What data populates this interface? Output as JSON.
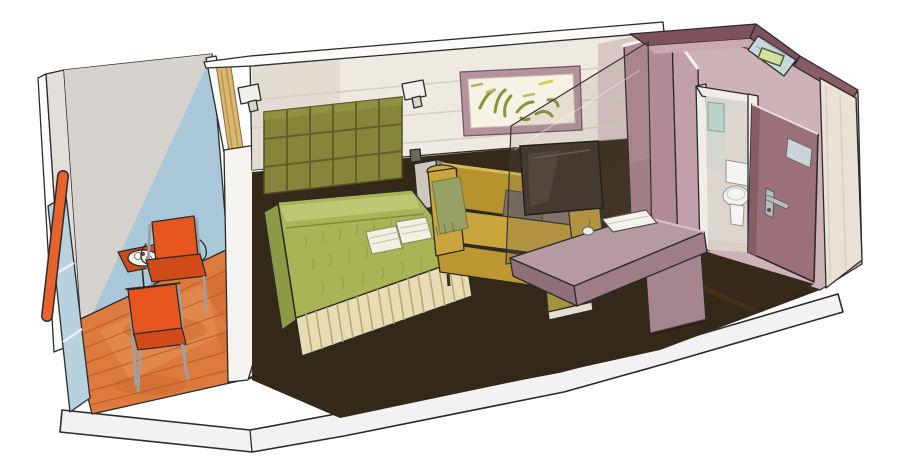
{
  "title": "Cruise ship balcony cabin — hand-drawn cutaway illustration",
  "scene": {
    "balcony": [
      "side-wall",
      "glass-back-wall",
      "wood-deck",
      "railing-with-orange-handrail",
      "two-orange-chairs",
      "bistro-table",
      "tray-with-cups"
    ],
    "bedroom": [
      "tufted-headboard",
      "double-bed-green-spread",
      "pleated-bed-skirt",
      "two-folded-towels",
      "curtain",
      "two-wall-sconces",
      "outlet",
      "nightstand"
    ],
    "living_area": [
      "mustard-sofa",
      "olive-throw",
      "two-back-cushions",
      "framed-abstract-artwork",
      "glass-partition",
      "flat-tv",
      "writing-desk",
      "stool",
      "notebook",
      "small-object"
    ],
    "bathroom": [
      "mauve-walls",
      "doorway",
      "mirror",
      "toilet",
      "ceiling-glass-panel",
      "light-fixture"
    ],
    "entry": [
      "open-cabin-door",
      "door-placard",
      "door-handle",
      "corridor-wall"
    ]
  },
  "palette": {
    "ink": "#2b2b2b",
    "paper": "#ffffff",
    "slab": "#f4f1f4",
    "balconySideWall": "#e2dfda",
    "balconyWallBlue": "#a9c7d9",
    "balconyWallGray": "#d6d3ce",
    "deck": "#dd7a3e",
    "deckWash": "#e89a62",
    "deckLine": "#b35a28",
    "deckShadow": "#c05820",
    "threshold": "#eceeec",
    "thresholdTick": "#555555",
    "railGlass": "#b7d1dd",
    "handrail": "#e8622e",
    "orangeFurniture": "#e8561f",
    "orangeDark": "#d14a1a",
    "metal": "#9aa2a8",
    "tray": "#f3f1ea",
    "partition": "#f6f4f0",
    "partitionTop": "#fbfaf8",
    "curtain": "#d9b873",
    "curtainFold": "#b9954a",
    "wall": "#eee9e1",
    "wallShade": "#ded8cf",
    "wallMauveTint": "#c9abb1",
    "wallPanelLine": "#d5cec3",
    "ceilingBand": "#fcfbf9",
    "headboard": "#85853c",
    "headboardHighlight": "#9a9a4a",
    "headboardLine": "#5d5d26",
    "sconce": "#f1efe9",
    "sconceBracket": "#d8d4cc",
    "outlet": "#6b665e",
    "nightstandFront": "#ccc8c0",
    "nightstandSide": "#8b857c",
    "carpet": "#342818",
    "carpetLight": "#443119",
    "bedTop": "#aab457",
    "bedFold": "#c3cc7a",
    "bedSide": "#8d9a45",
    "bedTexture": "#8a9840",
    "bedOverhang": "#9cab4e",
    "skirt": "#e7dcb4",
    "skirtStripe": "#b7a86f",
    "towel": "#f2efe3",
    "towelStripe": "#c9c2a4",
    "sofa": "#c9a53b",
    "sofaBack": "#b6932f",
    "sofaBase": "#bd9832",
    "sofaArmTop": "#cfab41",
    "sofaHighlight": "#d9b955",
    "cushionA": "#7a6c60",
    "cushionB": "#8a7b6d",
    "throw": "#97a065",
    "throwLine": "#6e7842",
    "artFrame": "#b4939c",
    "artCanvas": "#f6f2e4",
    "artStroke": "#8a9338",
    "artStrokeLight": "#b7bd62",
    "artStrokeTan": "#c9a86a",
    "artStrokeYellow": "#d8c84a",
    "glass": "rgba(125,112,98,0.14)",
    "glassLower": "rgba(95,82,70,0.12)",
    "tv": "#453a31",
    "tvReflection": "#564a3e",
    "desk": "#b59aa2",
    "deskFront": "#9d7e87",
    "deskSide": "#8f7079",
    "pedestal": "#a5858e",
    "stool": "#b7a34b",
    "stoolFront": "#a6923e",
    "stoolBase": "#e4dfd2",
    "notebook": "#f4f2ec",
    "vestibule": "#cdb2b8",
    "bathWallFront": "#b08a95",
    "bathWallCorner": "#c2a0a9",
    "plum": "#7d525b",
    "plumLight": "#caa9b0",
    "entryTopBand": "#8a5c64",
    "ceilingGlass": "#c6d7dd",
    "fixture": "#d2e0a2",
    "doorwayJamb": "#f1ece6",
    "bathInterior": "#ddd5cf",
    "bathTint": "#cfd8cf",
    "mirror": "#bcd3cc",
    "toilet": "#f4f4f2",
    "bathFloor": "#d8cfc6",
    "door": "#9b7078",
    "doorEdge": "#855d66",
    "placard": "#ccd3d8",
    "handleMetal": "#b9bcbe",
    "entryWall": "#eae2d6",
    "hallFloor": "#37291a"
  }
}
